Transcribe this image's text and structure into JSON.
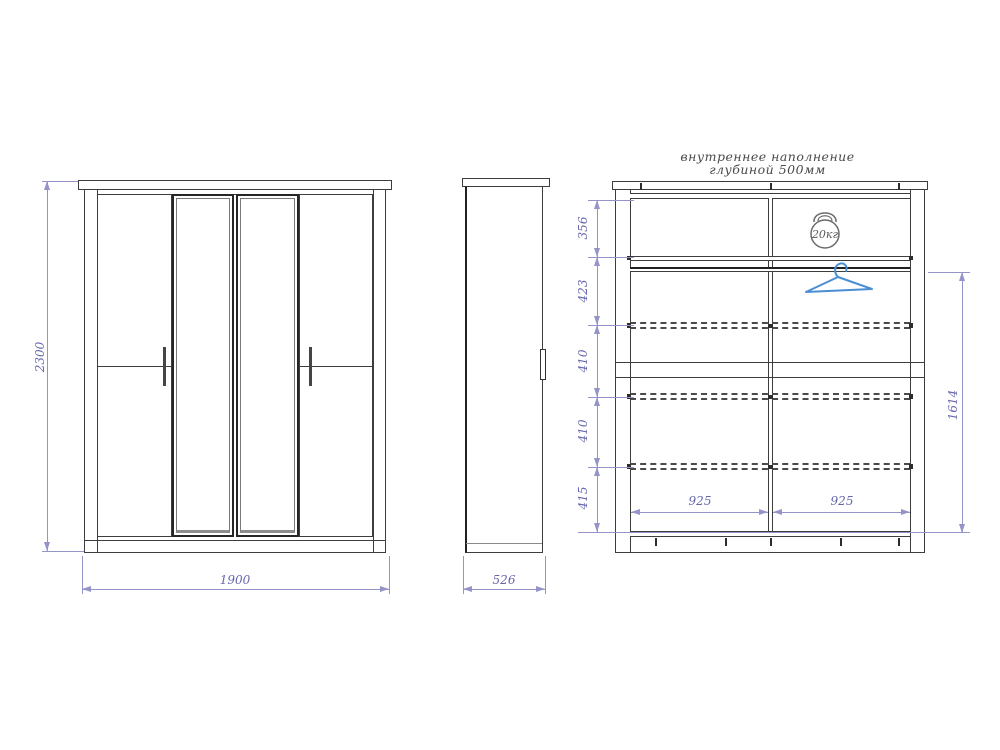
{
  "title": {
    "line1": "внутреннее наполнение",
    "line2": "глубиной 500мм"
  },
  "dims": {
    "height": "2300",
    "width": "1900",
    "depth": "526",
    "sections": [
      "356",
      "423",
      "410",
      "410",
      "415"
    ],
    "inner_widths": [
      "925",
      "925"
    ],
    "hanging_height": "1614",
    "max_load": "20кг"
  },
  "icons": {
    "kettlebell": "kettlebell-20kg-icon",
    "hanger": "clothes-hanger-icon"
  },
  "colors": {
    "line": "#3d3d3d",
    "dimension": "#9494c9",
    "dimension_text": "#6666ae",
    "hanger_blue": "#4a8fd4"
  }
}
